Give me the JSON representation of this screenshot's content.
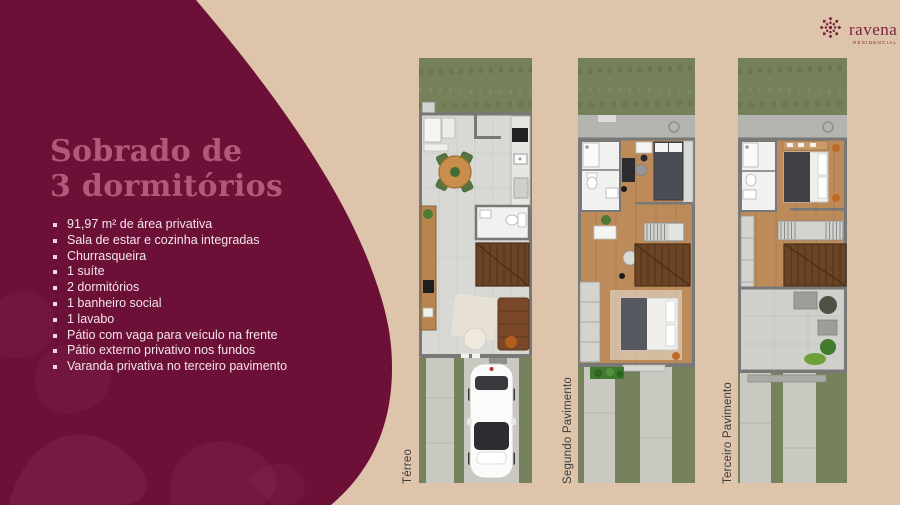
{
  "page": {
    "background_color": "#dec4ab"
  },
  "panel": {
    "background_color": "#6d1038",
    "title_line1": "Sobrado de",
    "title_line2": "3 dormitórios",
    "title_color": "#b25878",
    "bullet_color": "#f2e5ea",
    "bullets": [
      "91,97 m² de área privativa",
      "Sala de estar e cozinha integradas",
      "Churrasqueira",
      "1 suíte",
      "2 dormitórios",
      "1 banheiro social",
      "1 lavabo",
      "Pátio com vaga para veículo na frente",
      "Pátio externo privativo nos fundos",
      "Varanda privativa no terceiro pavimento"
    ]
  },
  "logo": {
    "icon": "rosette-mandala-icon",
    "wordmark": "ravena",
    "subtitle": "RESIDENCIAL",
    "color": "#7c2240"
  },
  "plans": [
    {
      "label": "Térreo"
    },
    {
      "label": "Segundo Pavimento"
    },
    {
      "label": "Terceiro Pavimento"
    }
  ],
  "label_color": "#3b3b3b"
}
